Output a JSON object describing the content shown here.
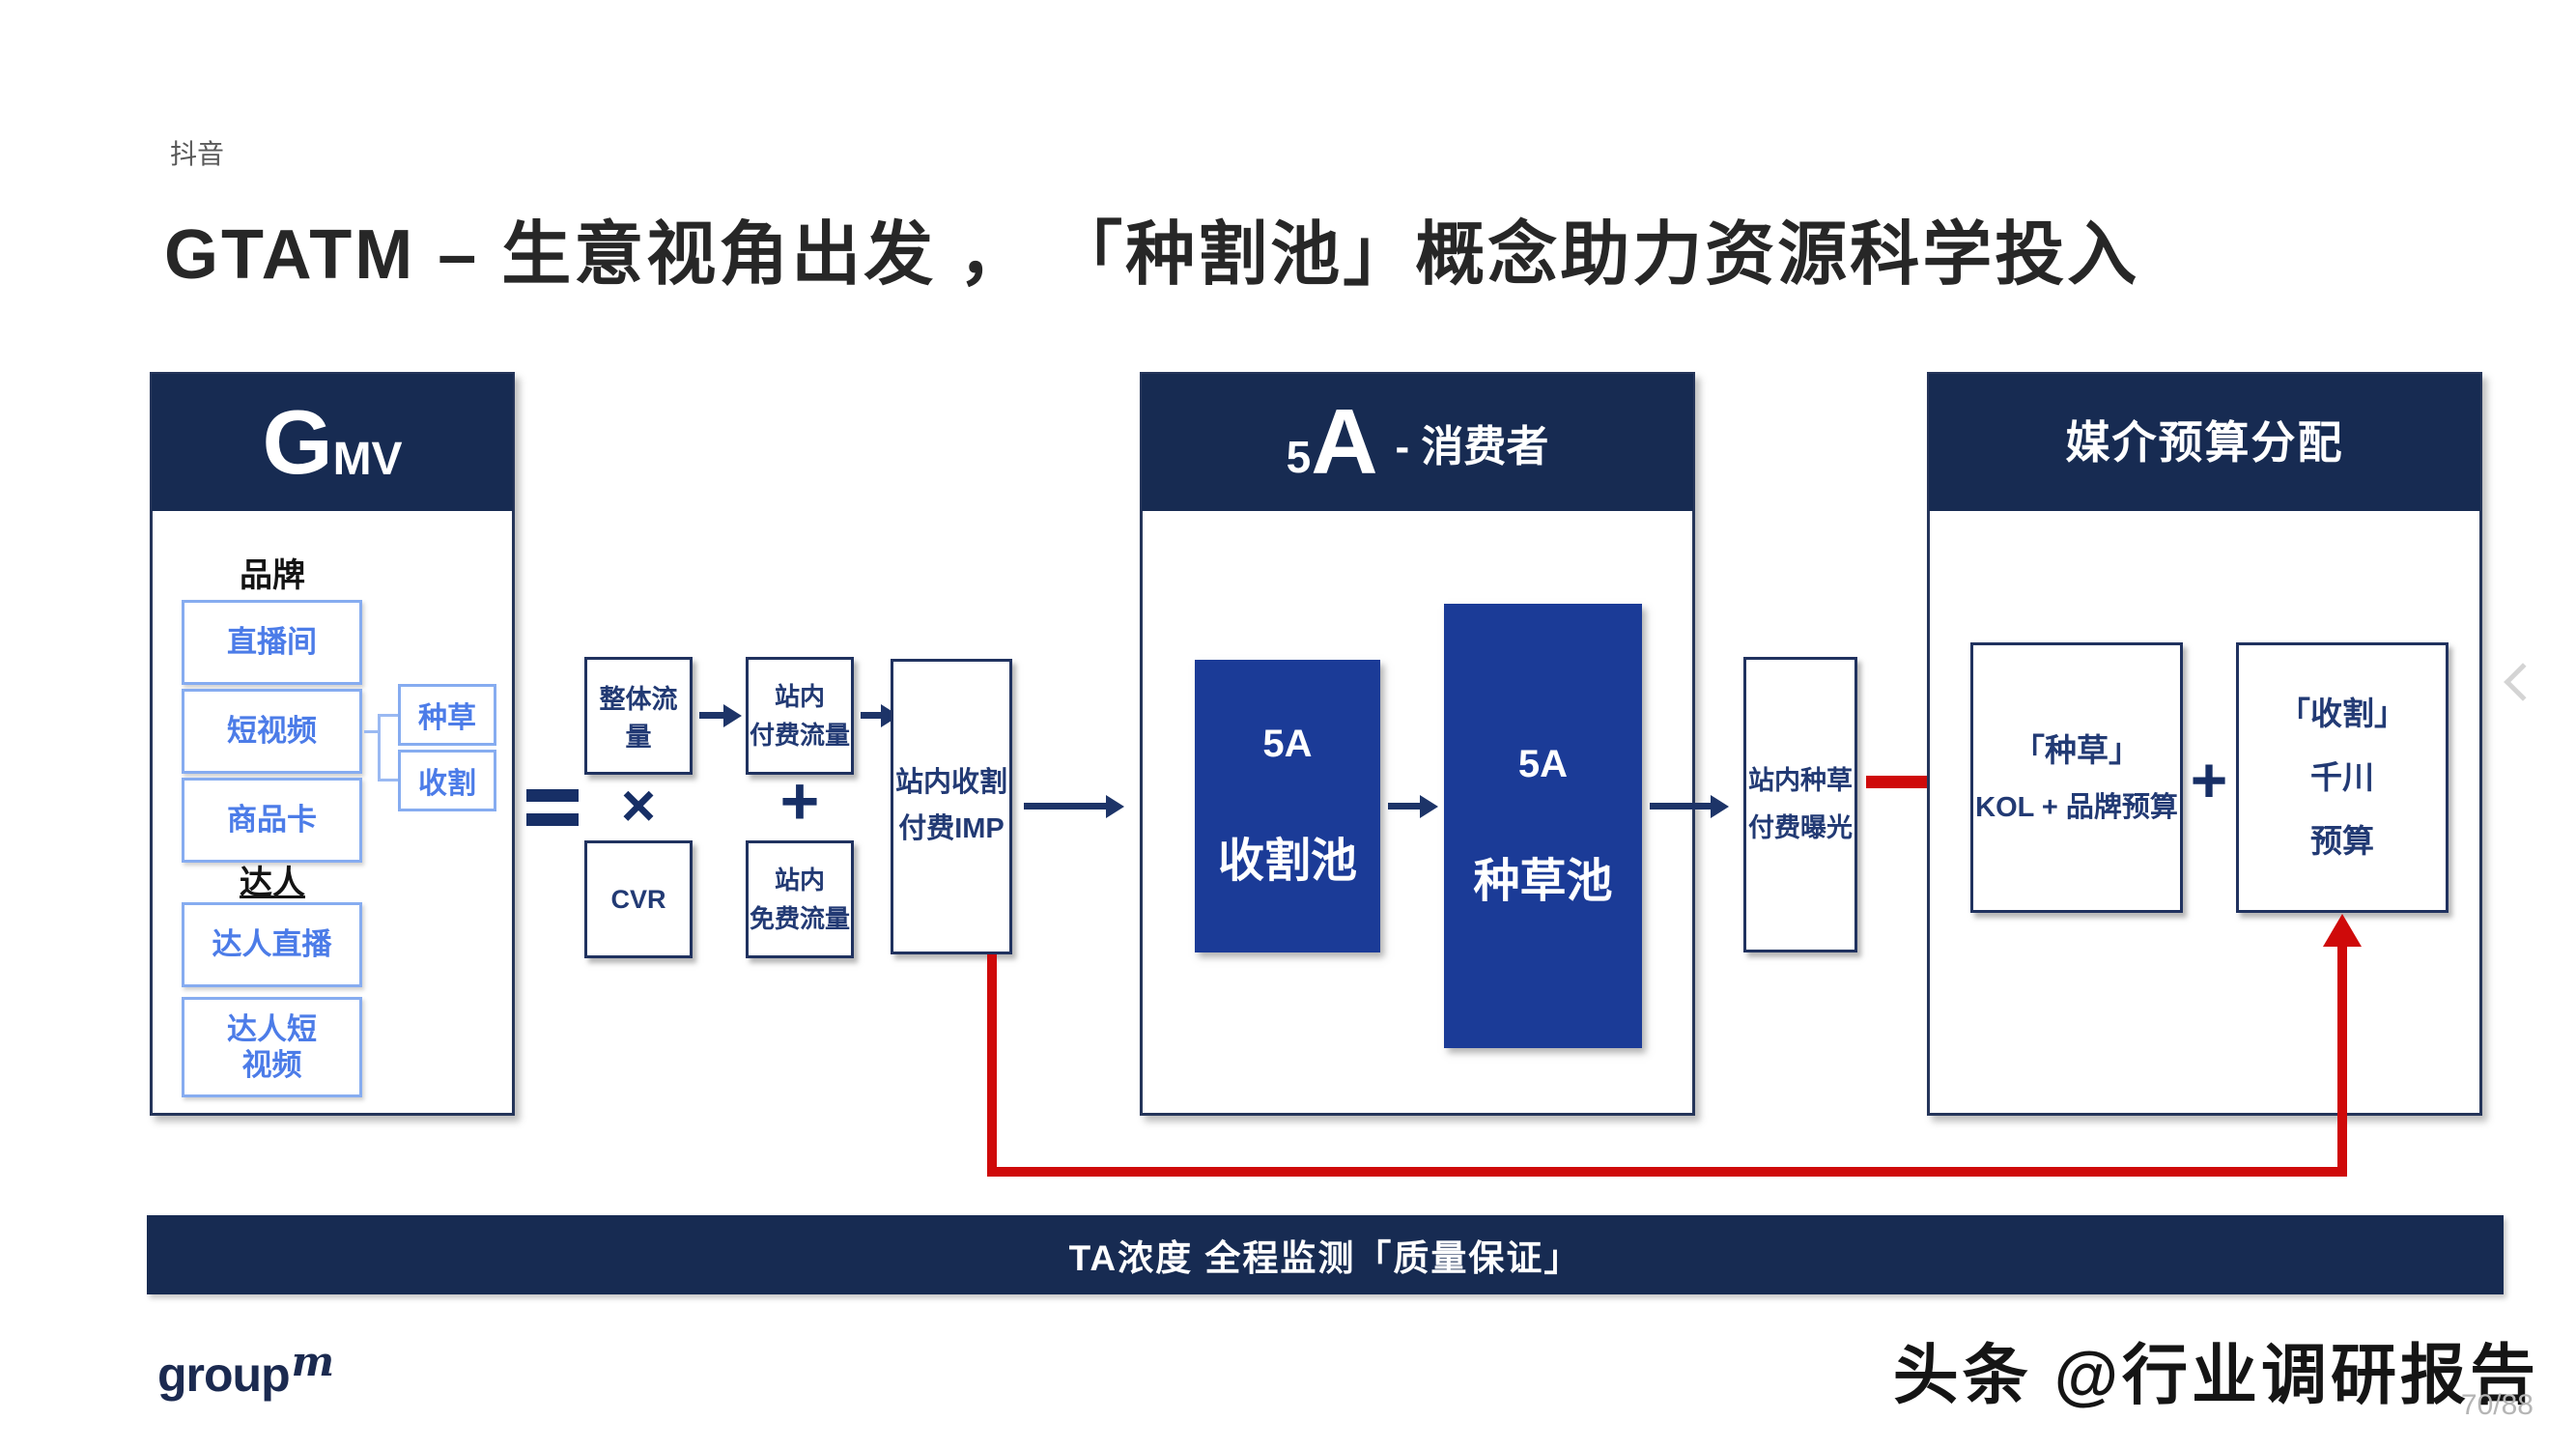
{
  "page": {
    "tag": "抖音",
    "title": "GTATM – 生意视角出发 ， 「种割池」概念助力资源科学投入",
    "page_indicator": "70/88",
    "watermark": "头条 @行业调研报告"
  },
  "logo": {
    "text": "group",
    "sup": "m"
  },
  "colors": {
    "header_navy": "#172b52",
    "pool_blue": "#1b3b97",
    "accent_red": "#cf0a0a",
    "light_blue_text": "#4c7ce8",
    "light_blue_border": "#86acf0",
    "panel_border": "#25355a"
  },
  "gmv": {
    "header_main": "G",
    "header_sub": "MV",
    "brand_label": "品牌",
    "brand_items": [
      "直播间",
      "短视频",
      "商品卡"
    ],
    "talent_label": "达人",
    "talent_items": [
      "达人直播",
      "达人短视频"
    ],
    "tags": [
      "种草",
      "收割"
    ]
  },
  "flow": {
    "multiply": "×",
    "plus": "+",
    "total_traffic": "整体流量",
    "cvr": "CVR",
    "paid_traffic": [
      "站内",
      "付费流量"
    ],
    "free_traffic": [
      "站内",
      "免费流量"
    ],
    "harvest_imp": [
      "站内收割",
      "付费IMP"
    ],
    "seed_exposure": [
      "站内种草",
      "付费曝光"
    ]
  },
  "consumer": {
    "header_num": "5",
    "header_letter": "A",
    "header_suffix": "- 消费者",
    "harvest_pool": [
      "5A",
      "收割池"
    ],
    "seed_pool": [
      "5A",
      "种草池"
    ]
  },
  "budget": {
    "header": "媒介预算分配",
    "plus": "+",
    "seed_budget": [
      "「种草」",
      "KOL + 品牌预算"
    ],
    "harvest_budget": [
      "「收割」",
      "千川",
      "预算"
    ]
  },
  "footer": {
    "band": "TA浓度 全程监测「质量保证」"
  }
}
